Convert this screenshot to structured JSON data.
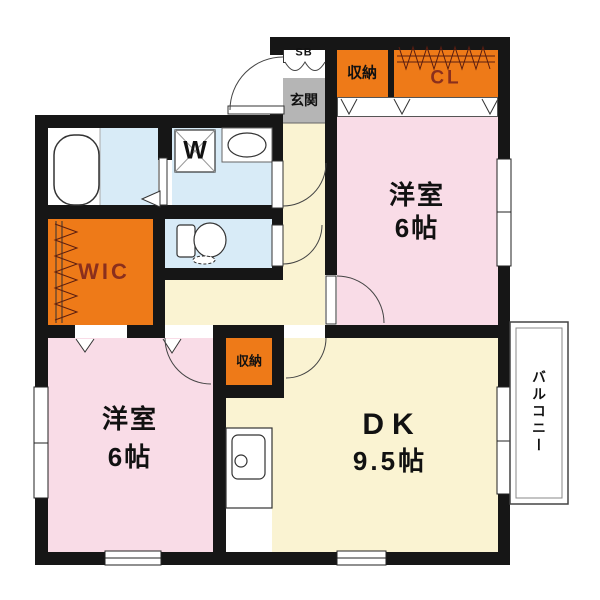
{
  "title": "2DK apartment floor plan",
  "colors": {
    "wall": "#161616",
    "bedroom_pink": "#f9dce7",
    "hall_cream": "#faf3d2",
    "wet_area_blue": "#d8ebf7",
    "closet_orange": "#ee7a18",
    "entrance_gray": "#b5b5b5",
    "closet_text": "#8a2f1d"
  },
  "entrance": {
    "shoebox_label": "SB",
    "label": "玄関"
  },
  "storage": {
    "top_storage_label": "収納",
    "closet_label": "CL",
    "wic_label": "WIC",
    "hall_storage_label": "収納"
  },
  "rooms": {
    "bedroom_ne": {
      "name": "洋室",
      "size": "6帖"
    },
    "bedroom_sw": {
      "name": "洋室",
      "size": "6帖"
    },
    "dining_kitchen": {
      "name": "DK",
      "size": "9.5帖"
    }
  },
  "fixtures": {
    "washer_label": "W"
  },
  "balcony": {
    "label": "バルコニー"
  }
}
